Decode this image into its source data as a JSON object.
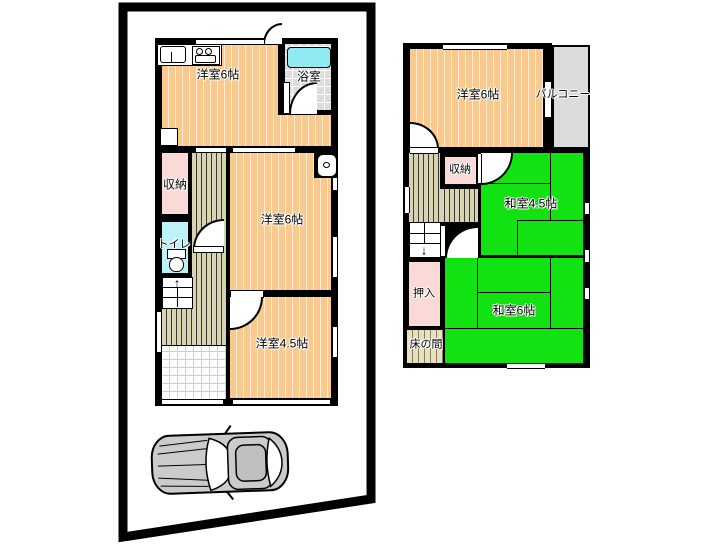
{
  "floor1": {
    "room_top": "洋室6帖",
    "bath": "浴室",
    "storage": "収納",
    "toilet": "トイレ",
    "room_mid": "洋室6帖",
    "room_small": "洋室4.5帖",
    "stairs_arrow": "↑"
  },
  "floor2": {
    "room_west": "洋室6帖",
    "balcony": "バルコニー",
    "storage": "収納",
    "washitsu_small": "和室4.5帖",
    "oshiire": "押入",
    "washitsu_main": "和室6帖",
    "tokonoma": "床の間",
    "stairs_arrow": "↓"
  },
  "icons": {
    "car": "car-top-view",
    "kitchen": "sink-and-stove",
    "bathtub": "bathtub",
    "toilet": "toilet-bowl",
    "washbasin": "washbasin"
  },
  "colors": {
    "room_orange": "#FAC98D",
    "tatami_green": "#12E212",
    "hall_olive": "#D6D2B2",
    "closet_pink": "#FBD9D7",
    "water_cyan": "#BCF3F8",
    "tub_cyan": "#8FEAF2",
    "balcony_gray": "#DCDCDC",
    "wall_black": "#000000"
  }
}
